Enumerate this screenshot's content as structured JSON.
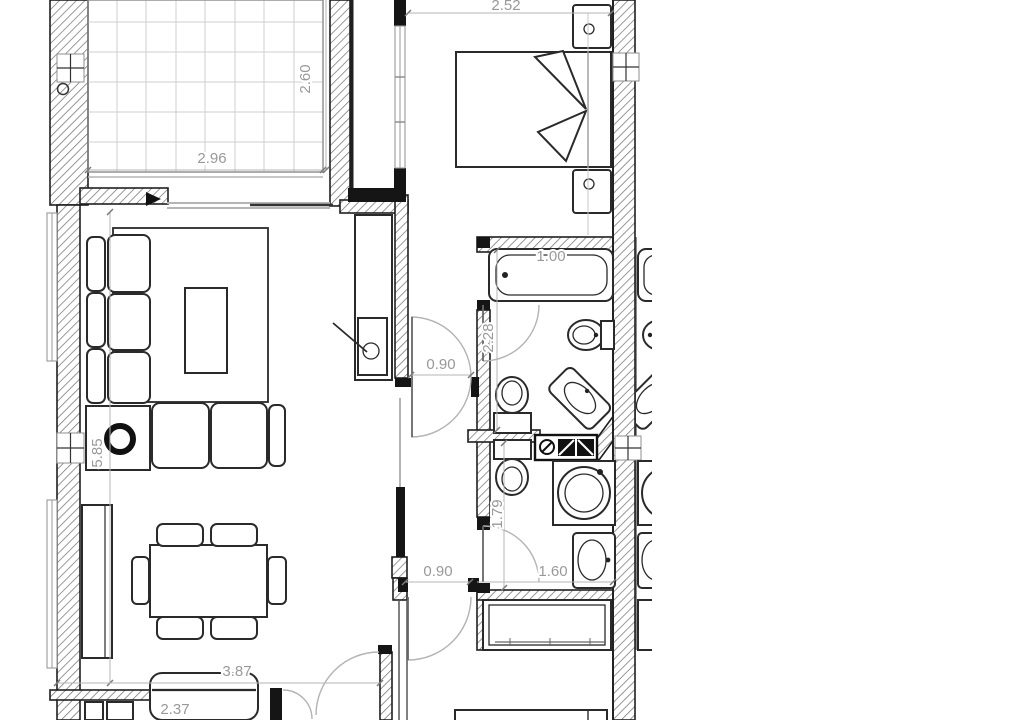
{
  "document": {
    "type": "architectural floor plan",
    "view": "top-down apartment plan, partially cropped at top, bottom and right edges",
    "units": "meters"
  },
  "dimension_labels": {
    "bedroom_width": "2.52",
    "balcony_depth": "2.60",
    "balcony_width": "2.96",
    "bathtub_length": "1.00",
    "bathroom_depth": "2.28",
    "bathroom_door_width": "0.90",
    "living_room_length": "5.85",
    "wc_depth": "1.79",
    "hall_door_width": "0.90",
    "wc_width": "1.60",
    "living_room_width": "3.87",
    "kitchen_width": "2.37"
  },
  "fixtures": {
    "balcony": "tiled terrace with 8x6 tile grid",
    "sliding_door": "balcony sliding glass door with direction arrow",
    "double_bed": "bed with fan-folded blanket and two nightstands",
    "bedroom_window": "tall window strip beside balcony shaft",
    "sofa": "L-shaped sectional sofa with cushions",
    "rug": "rectangular rug with coffee table",
    "side_table": "corner table with round floor lamp",
    "tv_unit": "tall TV cabinet with television and cable",
    "dining_table": "rectangular table with four chairs and two end seats",
    "sideboard": "tall cabinet on left wall",
    "kitchen_counter": "rounded counter at bottom (cut off)",
    "bathtub": "bathtub in upper bathroom",
    "wall_hung_toilet": "toilet beside bathtub",
    "corner_basin": "washbasin set across 45-degree corner wall",
    "toilets_back_to_back": "two toilets on shared wall",
    "washing_machine": "front-loading washer with round drum",
    "washbasin": "vanity sink in lower WC",
    "utility_counter": "dark counter with valve and appliance symbols",
    "wardrobe": "built-in wardrobe with hanging rod in lower room",
    "partial_bed": "bed in bottom room, cut by image edge",
    "columns": "square structural column markers in walls",
    "neighbor_unit": "mirrored fixtures of adjacent apartment, cut at right edge"
  },
  "colors": {
    "background": "#ffffff",
    "wall_line": "#1f1f1f",
    "hatch": "#767676",
    "furniture_line": "#2a2a2a",
    "dimension_text": "#999999",
    "dimension_line": "#b5b5b5",
    "tile_grid": "#cfcfcf",
    "door_arc": "#b3b3b3"
  }
}
